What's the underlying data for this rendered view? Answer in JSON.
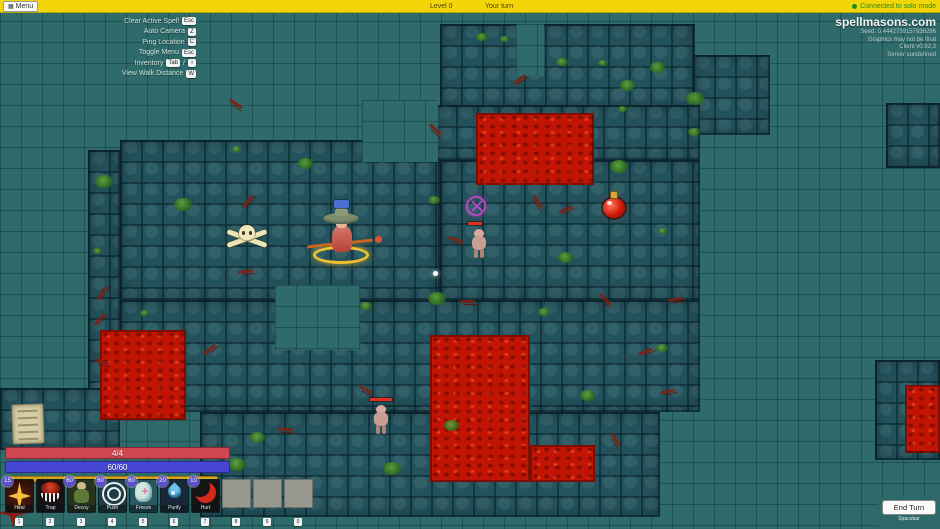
{
  "top_bar": {
    "menu_label": "Menu",
    "level_label": "Level 0",
    "turn_label": "Your turn",
    "connection_status": "Connected to solo mode"
  },
  "info_panel": {
    "site": "spellmasons.com",
    "lines": [
      "Seed: 0.4442739157936296",
      "Graphics may not be final",
      "Client v0.92.3",
      "Server vundefined"
    ]
  },
  "labels": {
    "key_separator": "/"
  },
  "hotkeys": [
    {
      "label": "Clear Active Spell",
      "keys": [
        "Esc"
      ]
    },
    {
      "label": "Auto Camera",
      "keys": [
        "Z"
      ]
    },
    {
      "label": "Ping Location",
      "keys": [
        "C"
      ]
    },
    {
      "label": "Toggle Menu",
      "keys": [
        "Esc"
      ]
    },
    {
      "label": "Inventory",
      "keys": [
        "Tab",
        "i"
      ]
    },
    {
      "label": "View Walk Distance",
      "keys": [
        "W"
      ]
    }
  ],
  "status_bars": {
    "health": {
      "label": "4/4",
      "color": "#cf4651"
    },
    "mana": {
      "label": "60/60",
      "color": "#4646d2"
    },
    "stamina": {
      "label": "100",
      "color": "#d8a61e"
    }
  },
  "toolbar": {
    "cards": [
      {
        "name": "Heal",
        "cost": "15",
        "hotkey": "1",
        "icon": "heal"
      },
      {
        "name": "Trap",
        "cost": "",
        "hotkey": "2",
        "icon": "trap"
      },
      {
        "name": "Decoy",
        "cost": "60",
        "hotkey": "3",
        "icon": "decoy"
      },
      {
        "name": "Push",
        "cost": "60",
        "hotkey": "4",
        "icon": "push"
      },
      {
        "name": "Freeze",
        "cost": "60",
        "hotkey": "5",
        "icon": "freeze"
      },
      {
        "name": "Purify",
        "cost": "20",
        "hotkey": "6",
        "icon": "purify"
      },
      {
        "name": "Hurt",
        "cost": "10",
        "hotkey": "7",
        "icon": "hurt"
      }
    ],
    "empty_slot_hotkeys": [
      "8",
      "9",
      "0"
    ]
  },
  "end_turn": {
    "label": "End Turn",
    "sublabel": "Spacebar"
  },
  "map": {
    "colors": {
      "background": "#2f6b6b",
      "floor": "#24525c",
      "lava": "#c21404"
    },
    "grid_cell": 21,
    "floors": [
      [
        440,
        24,
        255,
        86
      ],
      [
        693,
        55,
        77,
        80
      ],
      [
        886,
        103,
        54,
        65
      ],
      [
        120,
        140,
        320,
        160
      ],
      [
        88,
        150,
        32,
        268
      ],
      [
        435,
        105,
        265,
        55
      ],
      [
        440,
        160,
        260,
        140
      ],
      [
        120,
        300,
        580,
        112
      ],
      [
        200,
        412,
        460,
        105
      ],
      [
        875,
        360,
        65,
        100
      ],
      [
        0,
        388,
        120,
        62
      ]
    ],
    "voids": [
      [
        275,
        285,
        85,
        65
      ],
      [
        362,
        100,
        76,
        62
      ],
      [
        516,
        24,
        28,
        52
      ]
    ],
    "lavas": [
      [
        476,
        113,
        118,
        72
      ],
      [
        100,
        330,
        86,
        90
      ],
      [
        430,
        335,
        100,
        147
      ],
      [
        530,
        445,
        65,
        37
      ],
      [
        905,
        385,
        35,
        68
      ]
    ],
    "moss": [
      [
        500,
        36
      ],
      [
        556,
        58
      ],
      [
        620,
        80
      ],
      [
        686,
        92
      ],
      [
        232,
        146
      ],
      [
        428,
        196
      ],
      [
        558,
        252
      ],
      [
        428,
        292
      ],
      [
        598,
        60
      ],
      [
        656,
        344
      ],
      [
        250,
        432
      ],
      [
        383,
        462
      ],
      [
        618,
        106
      ],
      [
        476,
        33
      ],
      [
        298,
        158
      ],
      [
        174,
        198
      ],
      [
        93,
        248
      ],
      [
        538,
        308
      ],
      [
        444,
        420
      ],
      [
        228,
        458
      ],
      [
        658,
        228
      ],
      [
        688,
        128
      ],
      [
        650,
        62
      ],
      [
        610,
        160
      ],
      [
        140,
        310
      ],
      [
        360,
        302
      ],
      [
        580,
        390
      ],
      [
        95,
        175
      ]
    ],
    "vines": [
      [
        94,
        292
      ],
      [
        238,
        270
      ],
      [
        598,
        298
      ],
      [
        638,
        350
      ],
      [
        228,
        102
      ],
      [
        512,
        78
      ],
      [
        448,
        238
      ],
      [
        92,
        318
      ],
      [
        278,
        428
      ],
      [
        608,
        438
      ],
      [
        668,
        298
      ],
      [
        428,
        128
      ],
      [
        558,
        208
      ],
      [
        358,
        388
      ],
      [
        202,
        348
      ],
      [
        94,
        360
      ],
      [
        240,
        200
      ],
      [
        460,
        300
      ],
      [
        530,
        200
      ],
      [
        660,
        390
      ]
    ],
    "entities": [
      {
        "type": "scroll-pickup",
        "x": 12,
        "y": 404
      },
      {
        "type": "skull-bones",
        "x": 224,
        "y": 222
      },
      {
        "type": "player-wizard",
        "x": 313,
        "y": 200
      },
      {
        "type": "target-marker",
        "x": 466,
        "y": 196
      },
      {
        "type": "enemy",
        "x": 466,
        "y": 222,
        "hp": 14
      },
      {
        "type": "potion-pickup",
        "x": 603,
        "y": 191
      },
      {
        "type": "enemy",
        "x": 368,
        "y": 398,
        "hp": 22
      },
      {
        "type": "cursor-dot",
        "x": 433,
        "y": 271
      }
    ]
  }
}
